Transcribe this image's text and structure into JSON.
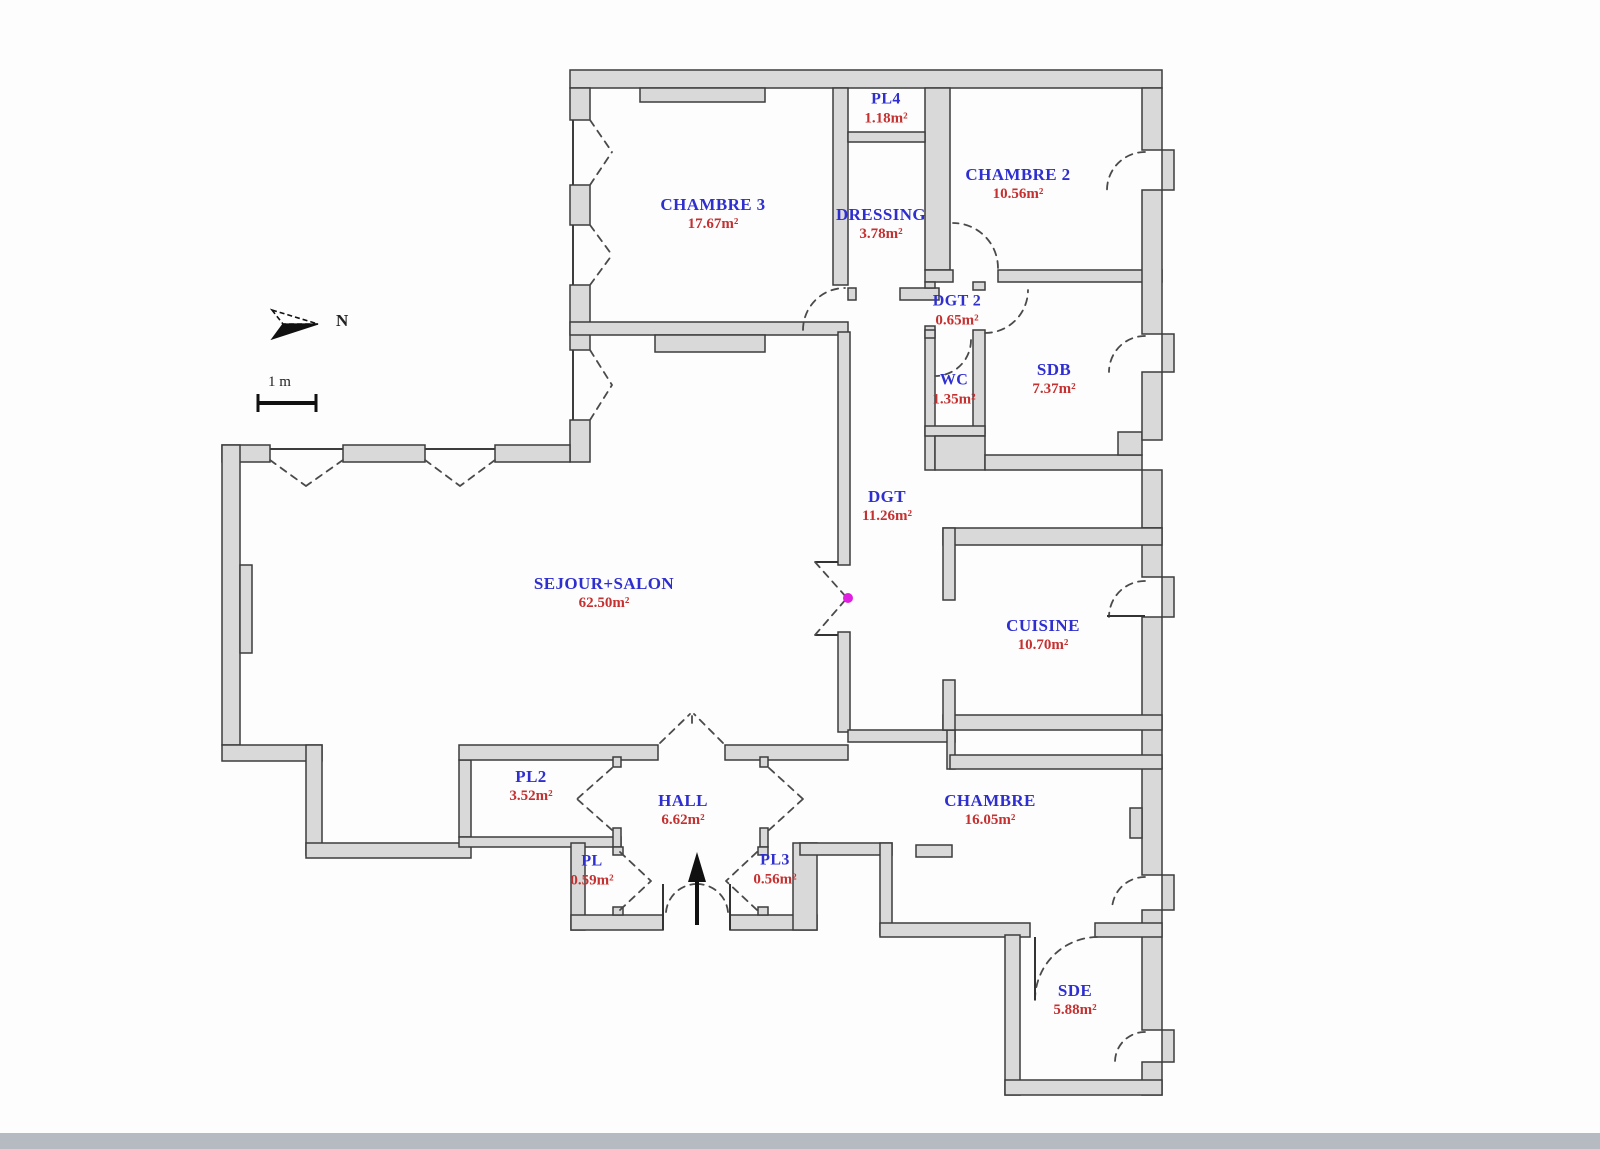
{
  "meta": {
    "north_label": "N",
    "scale_label": "1 m",
    "accent_colors": {
      "room_name": "#2f2fd0",
      "room_area": "#c53030",
      "wall_fill": "#d9d9d9",
      "sensor_dot": "#e020e0"
    }
  },
  "rooms": [
    {
      "name": "PL4",
      "area": "1.18m²"
    },
    {
      "name": "CHAMBRE 2",
      "area": "10.56m²"
    },
    {
      "name": "CHAMBRE 3",
      "area": "17.67m²"
    },
    {
      "name": "DRESSING",
      "area": "3.78m²"
    },
    {
      "name": "DGT 2",
      "area": "0.65m²"
    },
    {
      "name": "WC",
      "area": "1.35m²"
    },
    {
      "name": "SDB",
      "area": "7.37m²"
    },
    {
      "name": "DGT",
      "area": "11.26m²"
    },
    {
      "name": "SEJOUR+SALON",
      "area": "62.50m²"
    },
    {
      "name": "CUISINE",
      "area": "10.70m²"
    },
    {
      "name": "PL2",
      "area": "3.52m²"
    },
    {
      "name": "HALL",
      "area": "6.62m²"
    },
    {
      "name": "PL",
      "area": "0.59m²"
    },
    {
      "name": "PL3",
      "area": "0.56m²"
    },
    {
      "name": "CHAMBRE",
      "area": "16.05m²"
    },
    {
      "name": "SDE",
      "area": "5.88m²"
    }
  ]
}
